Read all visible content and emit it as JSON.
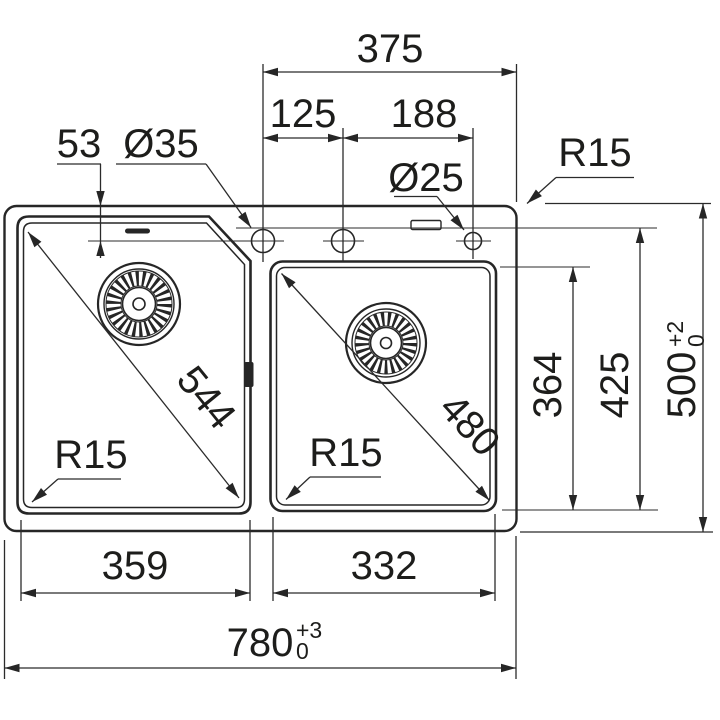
{
  "drawing": {
    "background": "#ffffff",
    "line_color": "#262626",
    "labels": {
      "top_width": "375",
      "hole_pitch_left": "125",
      "hole_pitch_right": "188",
      "deck_offset": "53",
      "hole_dia_large": "Ø35",
      "hole_dia_small": "Ø25",
      "corner_radius_rim": "R15",
      "corner_radius_left_bowl": "R15",
      "corner_radius_right_bowl": "R15",
      "left_bowl_diagonal": "544",
      "right_bowl_diagonal": "480",
      "right_bowl_depth": "364",
      "left_bowl_depth": "425",
      "overall_depth": "500",
      "overall_depth_tol_upper": "+2",
      "overall_depth_tol_lower": "0",
      "left_bowl_width": "359",
      "right_bowl_width": "332",
      "overall_width": "780",
      "overall_width_tol_upper": "+3",
      "overall_width_tol_lower": "0"
    }
  }
}
